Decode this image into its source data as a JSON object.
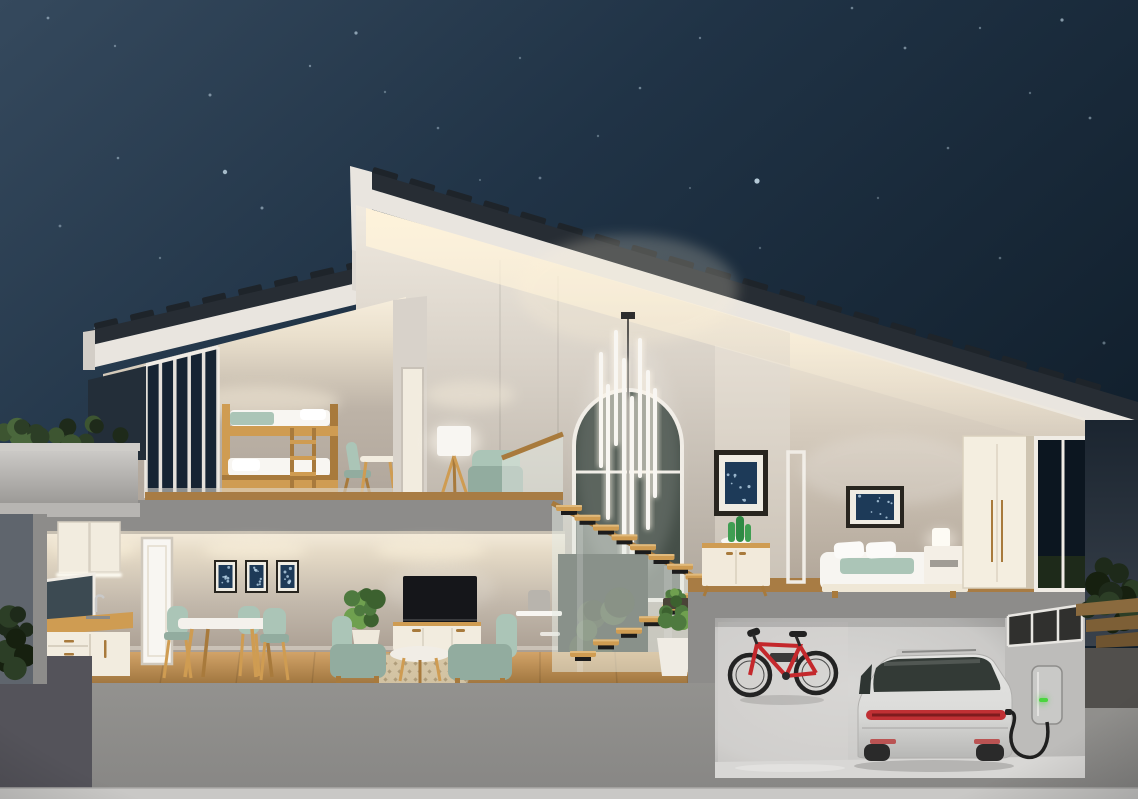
{
  "scene": {
    "title": "Night-time 3D cutaway rendering of a modern two-storey smart home with garage and EV charger",
    "setting": "night",
    "type": "3d-architecture-cutaway"
  },
  "rooms": [
    {
      "name": "kids-bedroom-loft",
      "items": [
        "wooden bunk bed",
        "ladder",
        "teal chair",
        "small wooden table",
        "corner window wall"
      ]
    },
    {
      "name": "upper-lounge",
      "items": [
        "tripod floor lamp",
        "teal daybed",
        "glass balustrade"
      ]
    },
    {
      "name": "stair-hall",
      "items": [
        "arched window",
        "vertical tube chandelier",
        "floating oak stairs",
        "frosted glass balustrade",
        "potted plants",
        "wall shelves"
      ]
    },
    {
      "name": "master-bedroom",
      "items": [
        "double bed with teal runner",
        "two pillows",
        "nightstand",
        "table lamp",
        "framed navy artwork",
        "tall wardrobe",
        "full-height window"
      ]
    },
    {
      "name": "kitchen",
      "items": [
        "upper cabinets",
        "under-cabinet light",
        "mirror backsplash",
        "faucet and sink",
        "wooden counter",
        "drawer cabinets",
        "white interior door"
      ]
    },
    {
      "name": "dining-area",
      "items": [
        "three framed navy artworks",
        "white dining table",
        "three teal chairs"
      ]
    },
    {
      "name": "living-room",
      "items": [
        "wall-mounted tv",
        "media console",
        "two teal armchairs",
        "round coffee table",
        "patterned rug",
        "potted plant",
        "wall shelf with speaker"
      ]
    },
    {
      "name": "landing",
      "items": [
        "framed navy artwork",
        "white sideboard",
        "cactus in white bowl",
        "door frame"
      ]
    },
    {
      "name": "garage",
      "items": [
        "wall-mounted red bicycle",
        "silver electric car rear view",
        "ev wall charger with green led",
        "charging cable",
        "clerestory windows"
      ]
    },
    {
      "name": "exterior",
      "items": [
        "starry night sky",
        "terrace planter hedge",
        "garden hedges",
        "outdoor wooden steps",
        "dark pavement"
      ]
    }
  ],
  "palette": {
    "skyTop": "#35495d",
    "skyMid": "#203346",
    "skyDeep": "#111f2c",
    "star": "#cfe4f2",
    "speckle": "#b9d4e8",
    "roofTile": "#272d34",
    "roofTileDark": "#1e242a",
    "fascia": "#e9e5df",
    "fasciaShade": "#d3cec7",
    "glow": "#fff3da",
    "lampGlow": "#fffaf0",
    "hallTop": "#efe9df",
    "hallBottom": "#a59c91",
    "wallTop": "#f5ecdb",
    "wallMid": "#c2b8ab",
    "wallBottom": "#ab9f93",
    "divider": "#d8d2ca",
    "nightGlass": "#162433",
    "frameWhite": "#f0ece5",
    "archGlass": "#454f48",
    "slab": "#8d8c8a",
    "slabLight": "#b7b5b2",
    "woodFloorTop": "#d2a368",
    "woodFloorBottom": "#a0763f",
    "woodStrip": "#a87c44",
    "woodFurn": "#cf9c52",
    "woodFurnDark": "#a87a3c",
    "teal": "#abc5b7",
    "tealDark": "#92ac9f",
    "cream": "#f2ecdf",
    "white": "#f8f6f2",
    "tvBlack": "#15161a",
    "artNavy": "#1d3a58",
    "artFrame": "#28251f",
    "artMat": "#efece3",
    "cactus": "#3f9e52",
    "plantGreen": "#4e7a3f",
    "plantLight": "#6fa04f",
    "hedgeDark": "#1e2a1a",
    "hedgeMid": "#2c3e26",
    "hedgeLight": "#3d5531",
    "glassFrost": "rgba(227,233,225,0.55)",
    "stringer": "#1c1c1c",
    "foundation": "#93928f",
    "foundationDark": "#888785",
    "groundStrip": "#c9c8c6",
    "pavementDark": "#54535a",
    "garageWall": "#cbcac8",
    "garageWallDark": "#aeadab",
    "garageFloor": "#d8d7d5",
    "bikeRed": "#c4282c",
    "bikeDark": "#222222",
    "carBody": "#dcdcda",
    "carShade": "#b7b7b5",
    "carGlass": "#333a36",
    "tailRed": "#c03034",
    "chargerBody": "#c9c9c7",
    "ledGreen": "#4ad53e",
    "outsideNight": "#242e38"
  },
  "sky": {
    "stars": [
      [
        48,
        18,
        1.4,
        0.5
      ],
      [
        115,
        46,
        1.2,
        0.4
      ],
      [
        210,
        95,
        1.5,
        0.5
      ],
      [
        310,
        66,
        1.2,
        0.45
      ],
      [
        356,
        33,
        1.6,
        0.6
      ],
      [
        438,
        128,
        1.3,
        0.4
      ],
      [
        520,
        58,
        1.2,
        0.35
      ],
      [
        118,
        158,
        1.3,
        0.45
      ],
      [
        60,
        226,
        1.4,
        0.4
      ],
      [
        160,
        258,
        1.2,
        0.35
      ],
      [
        262,
        208,
        1.5,
        0.5
      ],
      [
        352,
        298,
        1.2,
        0.3
      ],
      [
        95,
        328,
        1.3,
        0.35
      ],
      [
        225,
        172,
        2.2,
        0.75
      ],
      [
        430,
        248,
        1.2,
        0.3
      ],
      [
        540,
        178,
        1.4,
        0.4
      ],
      [
        640,
        88,
        1.3,
        0.45
      ],
      [
        700,
        38,
        1.2,
        0.4
      ],
      [
        757,
        181,
        2.6,
        0.85
      ],
      [
        852,
        8,
        1.3,
        0.45
      ],
      [
        905,
        48,
        1.4,
        0.5
      ],
      [
        980,
        28,
        1.2,
        0.4
      ],
      [
        1062,
        20,
        1.6,
        0.6
      ],
      [
        1090,
        118,
        1.4,
        0.45
      ],
      [
        1030,
        93,
        1.2,
        0.35
      ],
      [
        948,
        148,
        1.3,
        0.4
      ],
      [
        878,
        198,
        1.2,
        0.3
      ],
      [
        1000,
        258,
        1.3,
        0.35
      ],
      [
        1104,
        343,
        1.5,
        0.4
      ],
      [
        760,
        248,
        1.2,
        0.3
      ],
      [
        690,
        188,
        1.1,
        0.3
      ],
      [
        598,
        136,
        1.2,
        0.35
      ],
      [
        480,
        180,
        1.1,
        0.3
      ],
      [
        385,
        92,
        1.2,
        0.35
      ]
    ]
  },
  "roofs": {
    "main": {
      "x0": 372,
      "x1": 1100,
      "step": 37,
      "xA": 350,
      "yA": 166,
      "slope": 0.2995,
      "angle": 16.7,
      "w": 26,
      "h": 9
    },
    "left": {
      "x0": 95,
      "x1": 392,
      "step": 36,
      "xA": 83,
      "yA": 332,
      "slope": -0.2353,
      "angle": -13.3,
      "w": 24,
      "h": 8
    }
  },
  "windows": {
    "bunk": {
      "x": 146,
      "w": 72,
      "topY0": 363,
      "slope": -0.25,
      "bottom": 498,
      "bars": 4
    }
  },
  "chandelier": {
    "tubes": [
      [
        601,
        352,
        468
      ],
      [
        608,
        384,
        520
      ],
      [
        616,
        330,
        446
      ],
      [
        624,
        358,
        562
      ],
      [
        632,
        396,
        608
      ],
      [
        640,
        338,
        478
      ],
      [
        648,
        370,
        530
      ],
      [
        655,
        388,
        498
      ]
    ]
  },
  "stairs": {
    "upper": {
      "n": 8,
      "x0": 556,
      "y0": 505,
      "dx": 18.5,
      "dy": 9.8
    },
    "lower": {
      "n": 6,
      "x0": 570,
      "y0": 651,
      "dx": 23,
      "dy": -11.6
    },
    "treadW": 26,
    "treadH": 6
  },
  "rug": {
    "x0": 384,
    "y0": 662,
    "cols": 9,
    "rows": 3,
    "dx": 10,
    "dy": 8
  },
  "clusters": [
    {
      "target": "g-hedgePlanter",
      "cx": 67,
      "cy": 434,
      "rx": 64,
      "ry": 12,
      "n": 18,
      "rmin": 6,
      "rmax": 11,
      "colors": [
        "#2c3e26",
        "#3d5531",
        "#1e2a1a",
        "#4a673c"
      ]
    },
    {
      "target": "g-hedgeLeft",
      "cx": 16,
      "cy": 636,
      "rx": 16,
      "ry": 38,
      "n": 10,
      "rmin": 7,
      "rmax": 12,
      "colors": [
        "#1e2a1a",
        "#16200f",
        "#2c3e26"
      ]
    },
    {
      "target": "g-hedgeRight",
      "cx": 1111,
      "cy": 598,
      "rx": 26,
      "ry": 38,
      "n": 16,
      "rmin": 7,
      "rmax": 13,
      "colors": [
        "#1e2a1a",
        "#2c3e26",
        "#16200f"
      ]
    },
    {
      "target": "g-stairWinFoliage",
      "cx": 604,
      "cy": 626,
      "rx": 36,
      "ry": 34,
      "n": 7,
      "rmin": 10,
      "rmax": 17,
      "colors": [
        "#26371f",
        "#1b2817",
        "#2f4527"
      ]
    },
    {
      "target": "g-livingPlant",
      "cx": 366,
      "cy": 607,
      "rx": 17,
      "ry": 16,
      "n": 10,
      "rmin": 5,
      "rmax": 10,
      "colors": [
        "#4e7a3f",
        "#6fa04f",
        "#3c612f"
      ]
    },
    {
      "target": "g-stairPlant",
      "cx": 674,
      "cy": 613,
      "rx": 16,
      "ry": 14,
      "n": 10,
      "rmin": 5,
      "rmax": 9,
      "colors": [
        "#4e7a3f",
        "#6fa04f",
        "#3c612f"
      ]
    },
    {
      "target": "g-treadTuft",
      "cx": 676,
      "cy": 597,
      "rx": 10,
      "ry": 5,
      "n": 5,
      "rmin": 3,
      "rmax": 5,
      "colors": [
        "#4e7a3f",
        "#6fa04f"
      ]
    }
  ],
  "garage_status": {
    "charger_led_color": "#4ad53e",
    "charger_state": "charging"
  }
}
